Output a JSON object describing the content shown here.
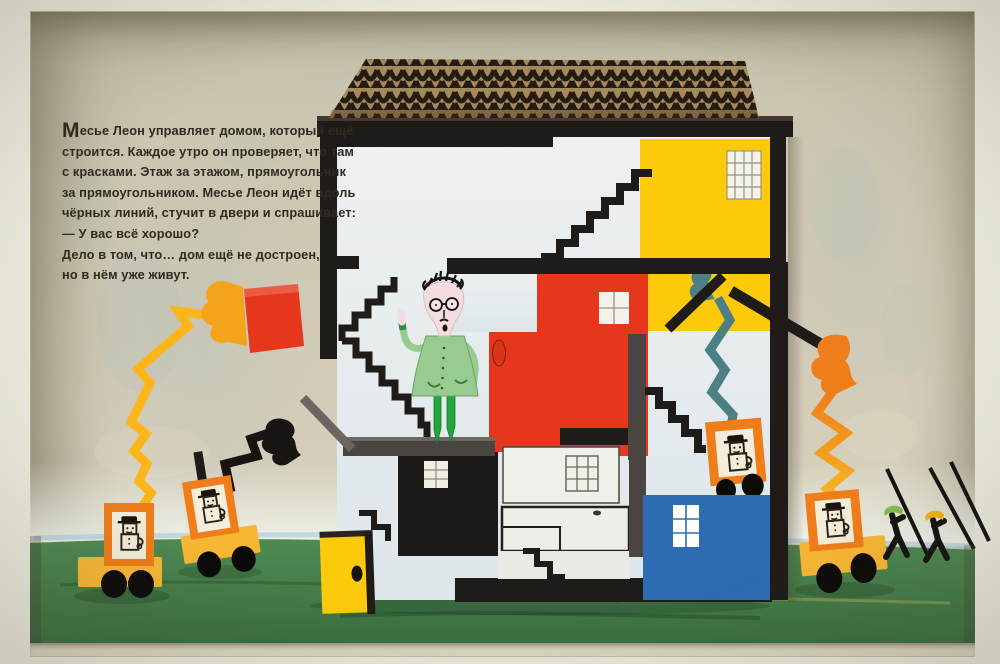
{
  "story": {
    "drop_cap": "М",
    "lines": [
      "есье Леон управляет домом, который ещё",
      "строится. Каждое утро он проверяет, что там",
      "с красками. Этаж за этажом, прямоугольник",
      "за прямоугольником. Месье Леон идёт вдоль",
      "чёрных линий, стучит в двери и спрашивает:",
      "— У вас всё хорошо?",
      "Дело в том, что… дом ещё не достроен,",
      "но в нём уже живут."
    ]
  },
  "palette": {
    "frame_outer": "#edebde",
    "wall": "#cdc7b2",
    "grass": "#47804b",
    "grass_deep": "#3a6f40",
    "horizon_blue": "#b7d2df",
    "roof_tan": "#a4895c",
    "roof_ink": "#241b11",
    "beam_black": "#1f1b18",
    "beam_grey": "#4b4542",
    "house_wall": "#e9eef0",
    "yellow": "#fcca0b",
    "red": "#e6371d",
    "blue": "#2e6db4",
    "orange": "#ef7d1a",
    "orange_body": "#f7b733",
    "teal": "#4d8084",
    "coat_green": "#97cb90",
    "leg_green": "#22a63e",
    "skin": "#f3dde1",
    "paper": "#f4edda",
    "ink_text": "#312a23"
  }
}
